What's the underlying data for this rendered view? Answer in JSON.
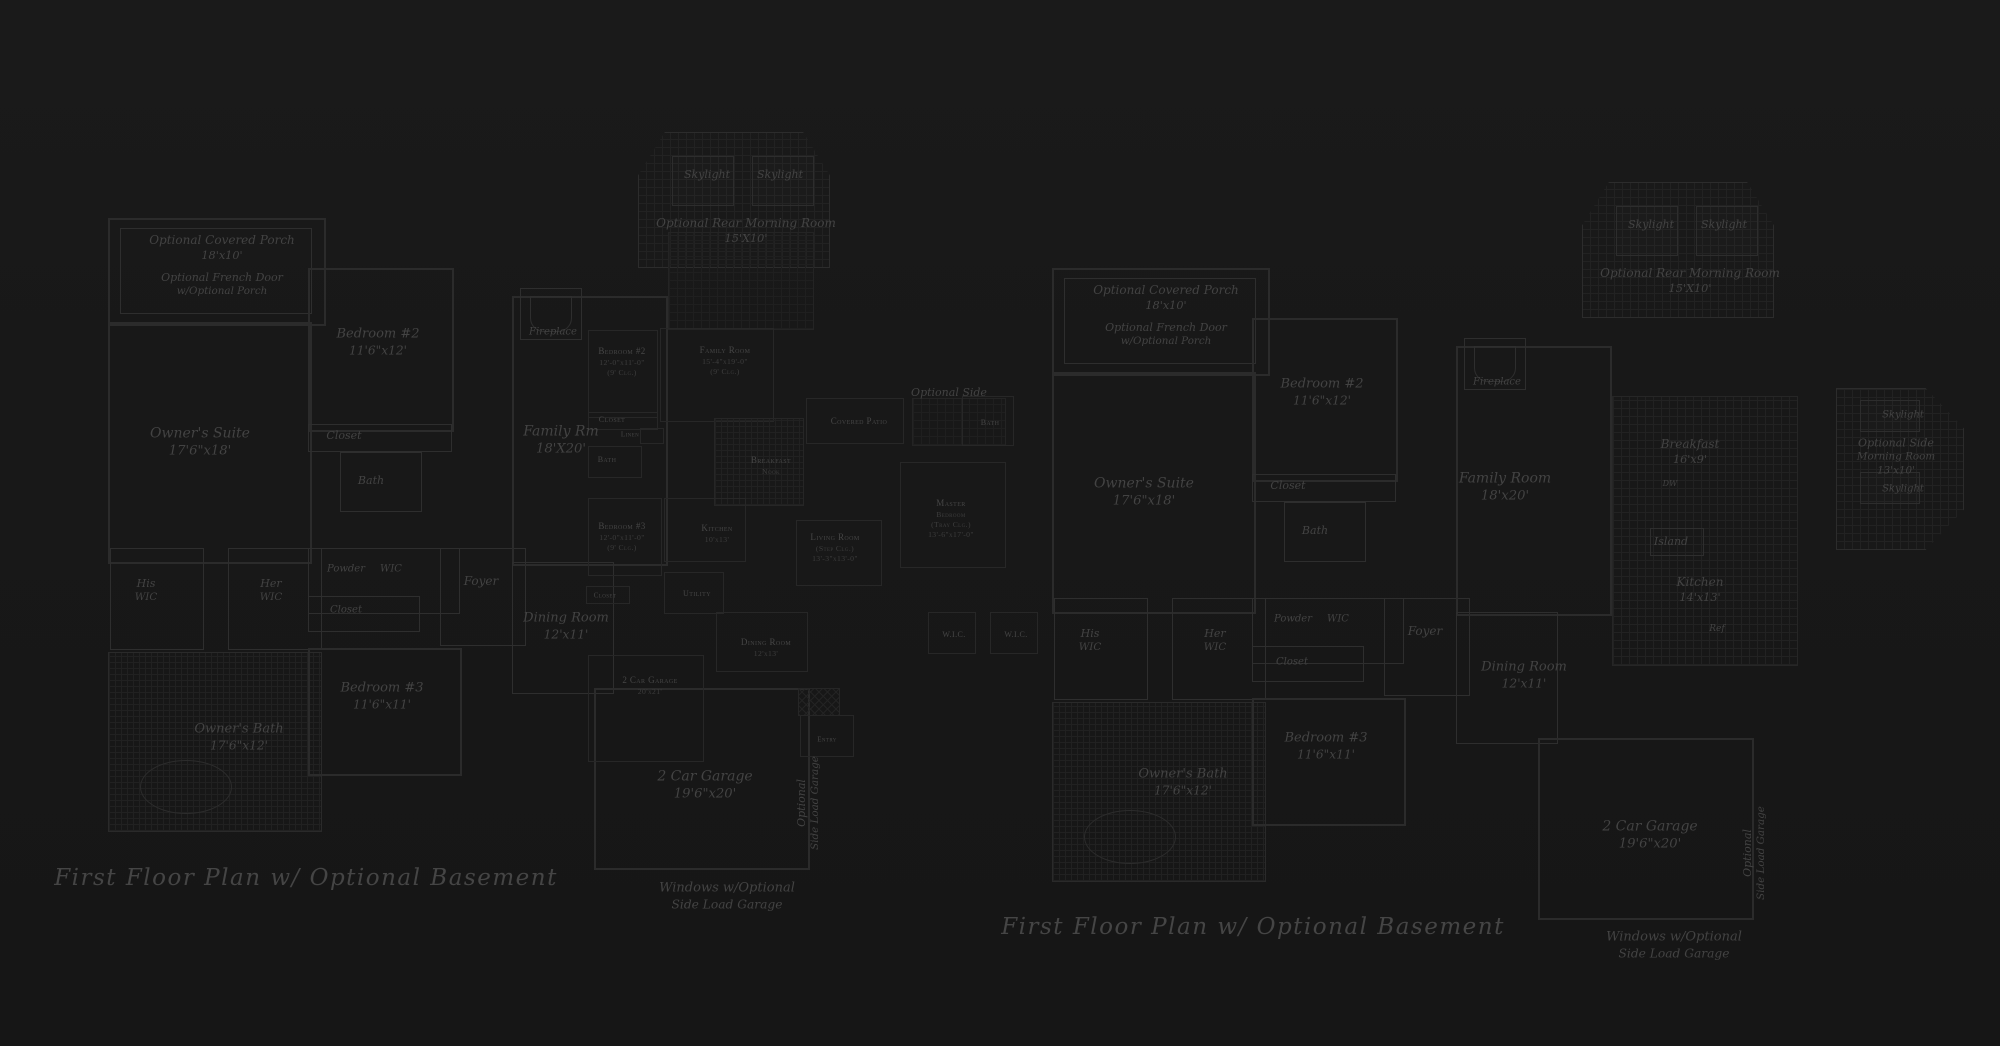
{
  "canvas": {
    "background": "#181818",
    "line_color": "#2b2b2b",
    "text_color": "#444444"
  },
  "captions": {
    "left": "First Floor Plan  w/ Optional Basement",
    "right": "First Floor Plan  w/ Optional Basement"
  },
  "plans": {
    "left": {
      "title": "First Floor Plan w/ Optional Basement (left drawing)",
      "labels": [
        {
          "id": "porch-label",
          "lines": [
            "Optional Covered Porch",
            "18'x10'"
          ],
          "x": 222,
          "y": 248,
          "fs": 12
        },
        {
          "id": "french-door-label",
          "lines": [
            "Optional French Door",
            "w/Optional Porch"
          ],
          "x": 222,
          "y": 285,
          "fs": 11
        },
        {
          "id": "bedroom2-label",
          "lines": [
            "Bedroom #2",
            "11'6\"x12'"
          ],
          "x": 378,
          "y": 343,
          "fs": 13
        },
        {
          "id": "closet-label",
          "lines": [
            "Closet"
          ],
          "x": 344,
          "y": 436,
          "fs": 11
        },
        {
          "id": "bath-label",
          "lines": [
            "Bath"
          ],
          "x": 371,
          "y": 481,
          "fs": 11
        },
        {
          "id": "owners-suite-label",
          "lines": [
            "Owner's Suite",
            "17'6\"x18'"
          ],
          "x": 200,
          "y": 442,
          "fs": 14
        },
        {
          "id": "his-wic-label",
          "lines": [
            "His",
            "WIC"
          ],
          "x": 146,
          "y": 591,
          "fs": 11
        },
        {
          "id": "her-wic-label",
          "lines": [
            "Her",
            "WIC"
          ],
          "x": 271,
          "y": 591,
          "fs": 11
        },
        {
          "id": "powder-label",
          "lines": [
            "Powder"
          ],
          "x": 346,
          "y": 569,
          "fs": 10
        },
        {
          "id": "wic-label",
          "lines": [
            "WIC"
          ],
          "x": 391,
          "y": 569,
          "fs": 10
        },
        {
          "id": "closet2-label",
          "lines": [
            "Closet"
          ],
          "x": 346,
          "y": 610,
          "fs": 10
        },
        {
          "id": "foyer-label",
          "lines": [
            "Foyer"
          ],
          "x": 481,
          "y": 582,
          "fs": 12
        },
        {
          "id": "skylight1-label",
          "lines": [
            "Skylight"
          ],
          "x": 707,
          "y": 175,
          "fs": 11
        },
        {
          "id": "skylight2-label",
          "lines": [
            "Skylight"
          ],
          "x": 780,
          "y": 175,
          "fs": 11
        },
        {
          "id": "morning-room-label",
          "lines": [
            "Optional Rear Morning Room",
            "15'X10'"
          ],
          "x": 746,
          "y": 231,
          "fs": 12
        },
        {
          "id": "fireplace-label",
          "lines": [
            "Fireplace"
          ],
          "x": 553,
          "y": 332,
          "fs": 10
        },
        {
          "id": "family-rm-label",
          "lines": [
            "Family Rm",
            "18'X20'"
          ],
          "x": 561,
          "y": 440,
          "fs": 14
        },
        {
          "id": "dining-room-label",
          "lines": [
            "Dining Room",
            "12'x11'"
          ],
          "x": 566,
          "y": 627,
          "fs": 13
        },
        {
          "id": "bedroom3-label",
          "lines": [
            "Bedroom #3",
            "11'6\"x11'"
          ],
          "x": 382,
          "y": 697,
          "fs": 13
        },
        {
          "id": "owners-bath-label",
          "lines": [
            "Owner's Bath",
            "17'6\"x12'"
          ],
          "x": 239,
          "y": 738,
          "fs": 13
        },
        {
          "id": "garage-label",
          "lines": [
            "2 Car Garage",
            "19'6\"x20'"
          ],
          "x": 705,
          "y": 785,
          "fs": 14
        },
        {
          "id": "side-load-garage-label",
          "s": "script vert",
          "lines": [
            "Optional",
            "Side Load Garage"
          ],
          "x": 809,
          "y": 803,
          "fs": 11
        },
        {
          "id": "windows-note-label",
          "lines": [
            "Windows w/Optional",
            "Side Load Garage"
          ],
          "x": 727,
          "y": 897,
          "fs": 13
        },
        {
          "id": "optional-side-label",
          "lines": [
            "Optional Side"
          ],
          "x": 949,
          "y": 393,
          "fs": 11
        }
      ]
    },
    "middle": {
      "title": "Small overlapping floor plan (small-caps labels)",
      "labels": [
        {
          "id": "m-bedroom2-label",
          "s": "caps",
          "lines": [
            "Bedroom #2",
            "12'-0\"x11'-0\"",
            "(9' Clg.)"
          ],
          "x": 622,
          "y": 362,
          "fs": 9
        },
        {
          "id": "m-family-room-label",
          "s": "caps",
          "lines": [
            "Family Room",
            "15'-4\"x19'-0\"",
            "(9' Clg.)"
          ],
          "x": 725,
          "y": 361,
          "fs": 9
        },
        {
          "id": "m-closet-label",
          "s": "caps",
          "lines": [
            "Closet"
          ],
          "x": 612,
          "y": 420,
          "fs": 8
        },
        {
          "id": "m-linen-label",
          "s": "caps",
          "lines": [
            "Linen"
          ],
          "x": 630,
          "y": 435,
          "fs": 7
        },
        {
          "id": "m-bath-label",
          "s": "caps",
          "lines": [
            "Bath"
          ],
          "x": 607,
          "y": 460,
          "fs": 8
        },
        {
          "id": "m-breakfast-nook-label",
          "s": "caps",
          "lines": [
            "Breakfast",
            "Nook"
          ],
          "x": 771,
          "y": 466,
          "fs": 9
        },
        {
          "id": "m-bedroom3-label",
          "s": "caps",
          "lines": [
            "Bedroom #3",
            "12'-0\"x11'-0\"",
            "(9' Clg.)"
          ],
          "x": 622,
          "y": 537,
          "fs": 9
        },
        {
          "id": "m-kitchen-label",
          "s": "caps",
          "lines": [
            "Kitchen",
            "10'x13'"
          ],
          "x": 717,
          "y": 534,
          "fs": 9
        },
        {
          "id": "m-living-room-label",
          "s": "caps",
          "lines": [
            "Living Room",
            "(Step Clg.)",
            "13'-3\"x13'-0\""
          ],
          "x": 835,
          "y": 548,
          "fs": 9
        },
        {
          "id": "m-dining-room-label",
          "s": "caps",
          "lines": [
            "Dining Room",
            "12'x13'"
          ],
          "x": 766,
          "y": 648,
          "fs": 9
        },
        {
          "id": "m-utility-label",
          "s": "caps",
          "lines": [
            "Utility"
          ],
          "x": 697,
          "y": 594,
          "fs": 8
        },
        {
          "id": "m-closet2-label",
          "s": "caps",
          "lines": [
            "Closet"
          ],
          "x": 605,
          "y": 596,
          "fs": 7
        },
        {
          "id": "m-garage-label",
          "s": "caps",
          "lines": [
            "2 Car Garage",
            "20'x21'"
          ],
          "x": 650,
          "y": 686,
          "fs": 9
        },
        {
          "id": "m-covered-patio-label",
          "s": "caps",
          "lines": [
            "Covered Patio"
          ],
          "x": 859,
          "y": 422,
          "fs": 9
        },
        {
          "id": "m-master-bedroom-label",
          "s": "caps",
          "lines": [
            "Master",
            "Bedroom",
            "(Tray Clg.)",
            "13'-6\"x17'-0\""
          ],
          "x": 951,
          "y": 519,
          "fs": 9
        },
        {
          "id": "m-bath2-label",
          "s": "caps",
          "lines": [
            "Bath"
          ],
          "x": 990,
          "y": 423,
          "fs": 8
        },
        {
          "id": "m-wic1-label",
          "s": "caps",
          "lines": [
            "W.I.C."
          ],
          "x": 954,
          "y": 635,
          "fs": 8
        },
        {
          "id": "m-wic2-label",
          "s": "caps",
          "lines": [
            "W.I.C."
          ],
          "x": 1016,
          "y": 635,
          "fs": 8
        },
        {
          "id": "m-entry-label",
          "s": "caps",
          "lines": [
            "Entry"
          ],
          "x": 827,
          "y": 740,
          "fs": 7
        }
      ]
    },
    "right": {
      "title": "First Floor Plan w/ Optional Basement (right drawing)",
      "labels": [
        {
          "id": "porch-label",
          "lines": [
            "Optional Covered Porch",
            "18'x10'"
          ],
          "x": 1166,
          "y": 298,
          "fs": 12
        },
        {
          "id": "french-door-label",
          "lines": [
            "Optional French Door",
            "w/Optional Porch"
          ],
          "x": 1166,
          "y": 335,
          "fs": 11
        },
        {
          "id": "bedroom2-label",
          "lines": [
            "Bedroom #2",
            "11'6\"x12'"
          ],
          "x": 1322,
          "y": 393,
          "fs": 13
        },
        {
          "id": "closet-label",
          "lines": [
            "Closet"
          ],
          "x": 1288,
          "y": 486,
          "fs": 11
        },
        {
          "id": "bath-label",
          "lines": [
            "Bath"
          ],
          "x": 1315,
          "y": 531,
          "fs": 11
        },
        {
          "id": "owners-suite-label",
          "lines": [
            "Owner's Suite",
            "17'6\"x18'"
          ],
          "x": 1144,
          "y": 492,
          "fs": 14
        },
        {
          "id": "his-wic-label",
          "lines": [
            "His",
            "WIC"
          ],
          "x": 1090,
          "y": 641,
          "fs": 11
        },
        {
          "id": "her-wic-label",
          "lines": [
            "Her",
            "WIC"
          ],
          "x": 1215,
          "y": 641,
          "fs": 11
        },
        {
          "id": "powder-label",
          "lines": [
            "Powder"
          ],
          "x": 1293,
          "y": 619,
          "fs": 10
        },
        {
          "id": "wic-label",
          "lines": [
            "WIC"
          ],
          "x": 1338,
          "y": 619,
          "fs": 10
        },
        {
          "id": "closet2-label",
          "lines": [
            "Closet"
          ],
          "x": 1292,
          "y": 662,
          "fs": 10
        },
        {
          "id": "foyer-label",
          "lines": [
            "Foyer"
          ],
          "x": 1425,
          "y": 632,
          "fs": 12
        },
        {
          "id": "skylight1-label",
          "lines": [
            "Skylight"
          ],
          "x": 1651,
          "y": 225,
          "fs": 11
        },
        {
          "id": "skylight2-label",
          "lines": [
            "Skylight"
          ],
          "x": 1724,
          "y": 225,
          "fs": 11
        },
        {
          "id": "morning-room-label",
          "lines": [
            "Optional Rear Morning Room",
            "15'X10'"
          ],
          "x": 1690,
          "y": 281,
          "fs": 12
        },
        {
          "id": "fireplace-label",
          "lines": [
            "Fireplace"
          ],
          "x": 1497,
          "y": 382,
          "fs": 10
        },
        {
          "id": "family-room-label",
          "lines": [
            "Family Room",
            "18'x20'"
          ],
          "x": 1505,
          "y": 487,
          "fs": 14
        },
        {
          "id": "breakfast-label",
          "lines": [
            "Breakfast",
            "16'x9'"
          ],
          "x": 1690,
          "y": 452,
          "fs": 12
        },
        {
          "id": "dw-label",
          "lines": [
            "DW"
          ],
          "x": 1670,
          "y": 484,
          "fs": 8
        },
        {
          "id": "island-label",
          "lines": [
            "Island"
          ],
          "x": 1671,
          "y": 542,
          "fs": 11
        },
        {
          "id": "kitchen-label",
          "lines": [
            "Kitchen",
            "14'x13'"
          ],
          "x": 1700,
          "y": 590,
          "fs": 12
        },
        {
          "id": "ref-label",
          "lines": [
            "Ref"
          ],
          "x": 1717,
          "y": 630,
          "fs": 9
        },
        {
          "id": "dining-room-label",
          "lines": [
            "Dining Room",
            "12'x11'"
          ],
          "x": 1524,
          "y": 676,
          "fs": 13
        },
        {
          "id": "bedroom3-label",
          "lines": [
            "Bedroom #3",
            "11'6\"x11'"
          ],
          "x": 1326,
          "y": 747,
          "fs": 13
        },
        {
          "id": "owners-bath-label",
          "lines": [
            "Owner's Bath",
            "17'6\"x12'"
          ],
          "x": 1183,
          "y": 783,
          "fs": 13
        },
        {
          "id": "garage-label",
          "lines": [
            "2 Car Garage",
            "19'6\"x20'"
          ],
          "x": 1650,
          "y": 835,
          "fs": 14
        },
        {
          "id": "side-load-garage-label",
          "s": "script vert",
          "lines": [
            "Optional",
            "Side Load Garage"
          ],
          "x": 1755,
          "y": 853,
          "fs": 11
        },
        {
          "id": "windows-note-label",
          "lines": [
            "Windows w/Optional",
            "Side Load Garage"
          ],
          "x": 1674,
          "y": 946,
          "fs": 13
        },
        {
          "id": "side-skylight1-label",
          "lines": [
            "Skylight"
          ],
          "x": 1903,
          "y": 415,
          "fs": 10
        },
        {
          "id": "side-morning-room-label",
          "lines": [
            "Optional Side",
            "Morning Room",
            "13'x10'"
          ],
          "x": 1896,
          "y": 457,
          "fs": 11
        },
        {
          "id": "side-skylight2-label",
          "lines": [
            "Skylight"
          ],
          "x": 1903,
          "y": 489,
          "fs": 10
        }
      ]
    }
  }
}
